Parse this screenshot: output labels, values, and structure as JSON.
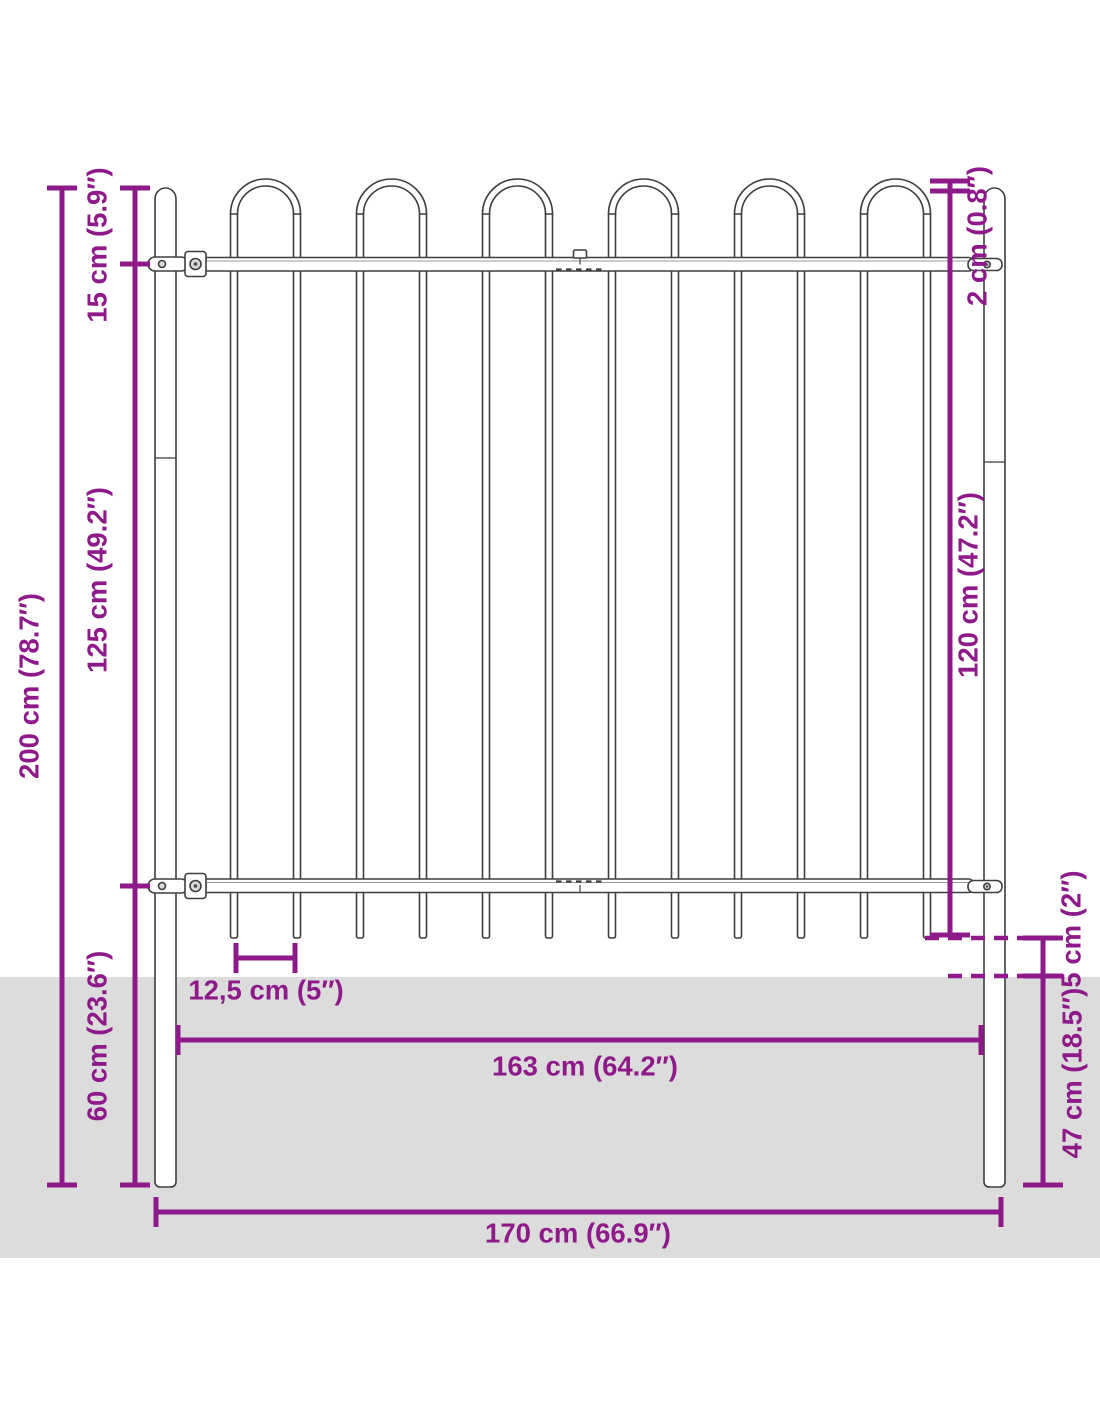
{
  "diagram": {
    "colors": {
      "accent": "#8e1a8a",
      "ground": "#dcdcdc",
      "outline": "#3e3e3e"
    },
    "fence": {
      "hoop_count": 6,
      "bar_count": 12
    },
    "dimensions": {
      "total_height": "200 cm (78.7″)",
      "post_top_to_rail": "15 cm (5.9″)",
      "rail_to_rail": "125 cm (49.2″)",
      "below_ground_left": "60 cm (23.6″)",
      "hoop_above_post": "2 cm (0.8″)",
      "panel_height": "120 cm (47.2″)",
      "spike_to_ground": "5 cm (2″)",
      "post_depth": "47 cm (18.5″)",
      "bar_spacing": "12,5 cm (5″)",
      "inner_width": "163 cm (64.2″)",
      "total_width": "170 cm (66.9″)"
    }
  }
}
